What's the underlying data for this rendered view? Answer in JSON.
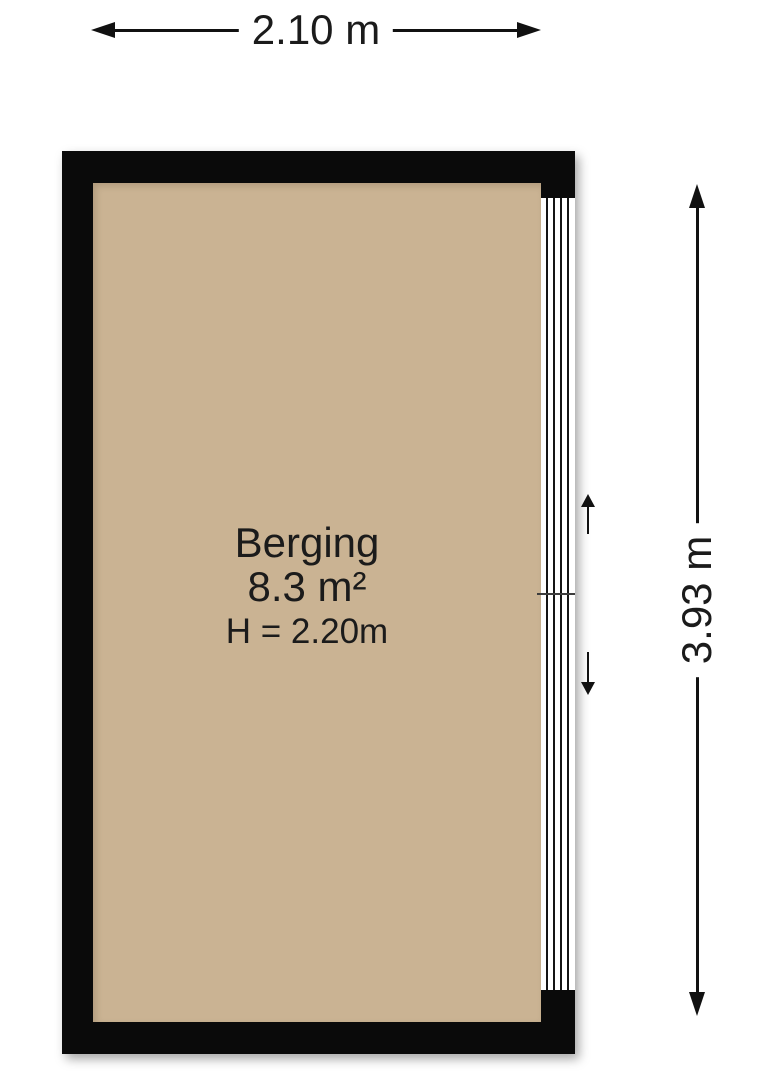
{
  "room": {
    "name": "Berging",
    "area": "8.3 m²",
    "ceiling_height": "H = 2.20m"
  },
  "dimensions": {
    "width_label": "2.10 m",
    "height_label": "3.93 m"
  },
  "colors": {
    "wall": "#0a0a0a",
    "floor": "#cab393",
    "background": "#ffffff",
    "line": "#111111"
  }
}
